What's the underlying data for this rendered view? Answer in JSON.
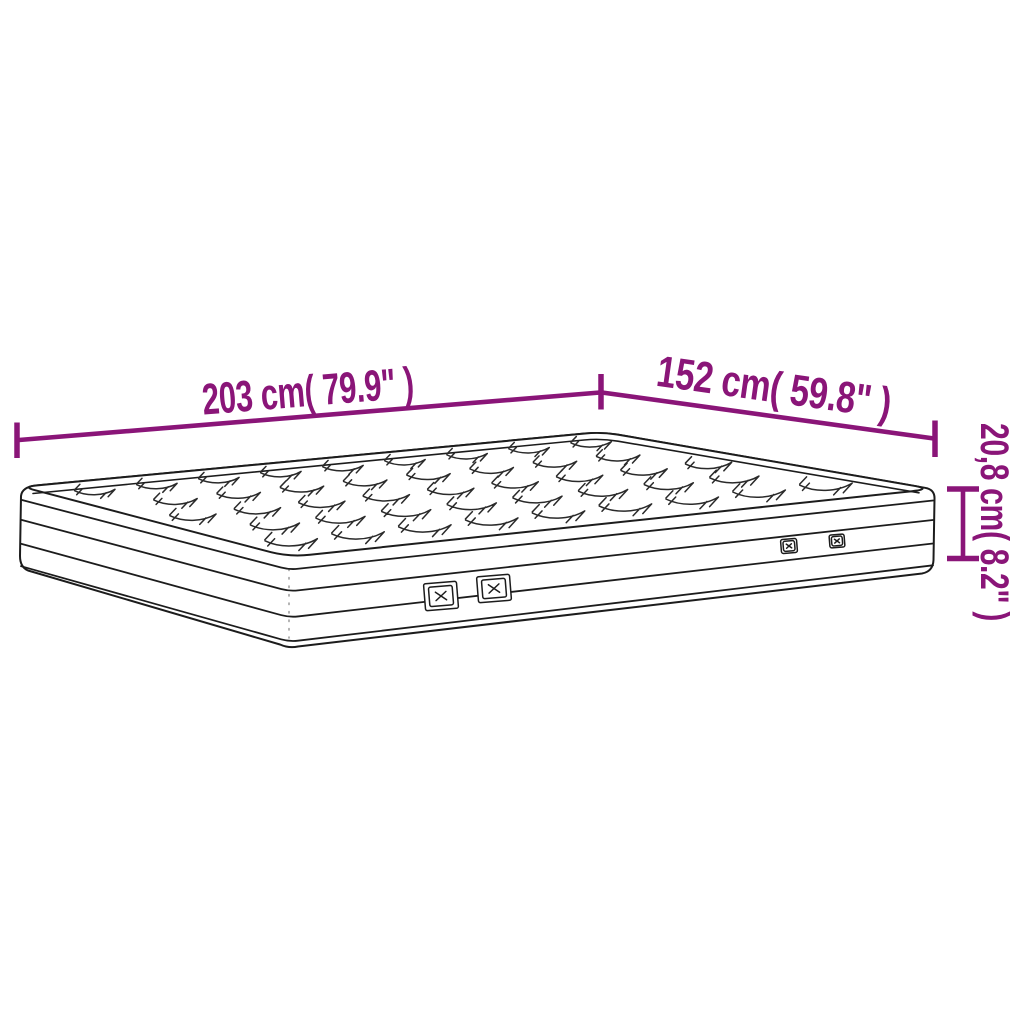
{
  "page": {
    "background": "#ffffff"
  },
  "colors": {
    "accent": "#8A1578",
    "line": "#1C1C1C"
  },
  "dimensions": {
    "length": {
      "label": "203 cm( 79.9\" )"
    },
    "width": {
      "label": "152 cm( 59.8\" )"
    },
    "height": {
      "label": "20,8 cm( 8.2\" )"
    }
  },
  "illustration": {
    "subject": "mattress",
    "features": [
      "quilted-top",
      "side-border-bands",
      "air-vents"
    ],
    "vent_count": 4
  }
}
